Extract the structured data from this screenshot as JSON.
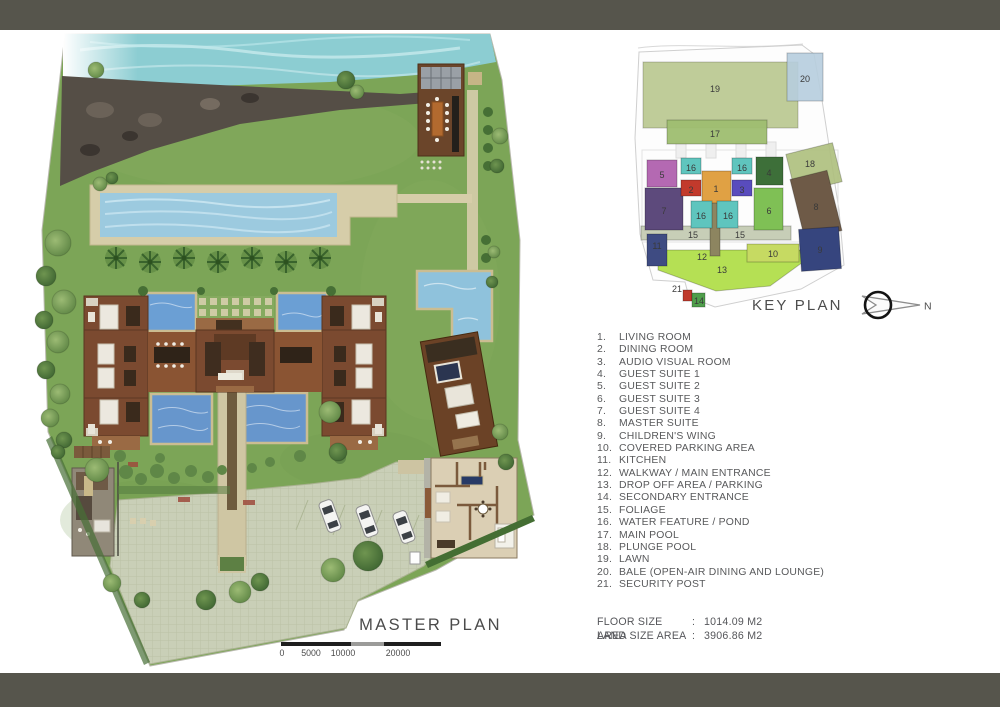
{
  "window": {
    "top_bar_color": "#56554c"
  },
  "master_plan": {
    "title": "MASTER PLAN",
    "scale_bar": {
      "labels": [
        "0",
        "5000",
        "10000",
        "20000"
      ],
      "positions": [
        1,
        30,
        62,
        117
      ],
      "segments": [
        {
          "w": 70,
          "c": "#1f1f1f"
        },
        {
          "w": 33,
          "c": "#9b9b99"
        },
        {
          "w": 57,
          "c": "#1f1f1f"
        }
      ]
    }
  },
  "key_plan": {
    "title": "KEY PLAN",
    "compass_label": "N",
    "blocks": [
      {
        "label": "19",
        "rect": [
          25,
          24,
          155,
          66
        ],
        "color": "#b5c488",
        "op": 0.85,
        "lx": 97,
        "ly": 51
      },
      {
        "label": "20",
        "rect": [
          169,
          15,
          36,
          48
        ],
        "color": "#b7cede",
        "op": 0.9,
        "lx": 187,
        "ly": 41
      },
      {
        "label": "17",
        "rect": [
          49,
          82,
          100,
          24
        ],
        "color": "#9fbe70",
        "op": 0.95,
        "lx": 97,
        "ly": 96
      },
      {
        "label": "18",
        "rect": [
          172,
          110,
          48,
          40
        ],
        "color": "#aebf7d",
        "op": 0.9,
        "rot": -14,
        "lx": 192,
        "ly": 126
      },
      {
        "label": "15",
        "rect": [
          23,
          188,
          150,
          14
        ],
        "color": "#c5ccb4",
        "op": 0.95,
        "lx": 75,
        "ly": 197
      },
      {
        "label": "15",
        "lx": 122,
        "ly": 197
      },
      {
        "label": "13",
        "poly": "40,212 182,212 185,224 152,248 98,253 40,232",
        "color": "#b2df4b",
        "op": 0.95,
        "lx": 104,
        "ly": 232
      },
      {
        "label": "10",
        "rect": [
          129,
          206,
          52,
          18
        ],
        "color": "#c6da62",
        "lx": 155,
        "ly": 216
      },
      {
        "label": "11",
        "rect": [
          29,
          196,
          20,
          32
        ],
        "color": "#3e4b82",
        "lx": 39,
        "ly": 208
      },
      {
        "label": "12",
        "rect": [
          92,
          160,
          10,
          58
        ],
        "color": "#8d8560",
        "lx": 84,
        "ly": 219
      },
      {
        "label": "21",
        "rect": [
          65,
          252,
          9,
          11
        ],
        "color": "#bf3a2c",
        "lx": 59,
        "ly": 251
      },
      {
        "label": "14",
        "rect": [
          74,
          255,
          13,
          14
        ],
        "color": "#4f9e4b",
        "lx": 81,
        "ly": 263
      },
      {
        "label": "5",
        "rect": [
          29,
          122,
          30,
          27
        ],
        "color": "#b469b2",
        "lx": 44,
        "ly": 137
      },
      {
        "label": "7",
        "rect": [
          27,
          150,
          38,
          42
        ],
        "color": "#5d4a7c",
        "lx": 46,
        "ly": 173
      },
      {
        "label": "2",
        "rect": [
          63,
          142,
          20,
          16
        ],
        "color": "#c23a2c",
        "lx": 73,
        "ly": 152
      },
      {
        "label": "1",
        "rect": [
          84,
          133,
          29,
          32
        ],
        "color": "#e0a144",
        "lx": 98,
        "ly": 151
      },
      {
        "label": "3",
        "rect": [
          114,
          142,
          20,
          16
        ],
        "color": "#594cbd",
        "lx": 124,
        "ly": 152
      },
      {
        "label": "16",
        "rect": [
          63,
          120,
          20,
          16
        ],
        "color": "#5fc5be",
        "lx": 73,
        "ly": 130
      },
      {
        "label": "16",
        "rect": [
          114,
          120,
          20,
          16
        ],
        "color": "#5fc5be",
        "lx": 124,
        "ly": 130
      },
      {
        "label": "16",
        "rect": [
          73,
          163,
          21,
          27
        ],
        "color": "#5fc5be",
        "lx": 83,
        "ly": 178
      },
      {
        "label": "16",
        "rect": [
          99,
          163,
          21,
          27
        ],
        "color": "#5fc5be",
        "lx": 110,
        "ly": 178
      },
      {
        "label": "4",
        "rect": [
          138,
          119,
          27,
          28
        ],
        "color": "#3d6f39",
        "lx": 151,
        "ly": 135
      },
      {
        "label": "6",
        "rect": [
          136,
          150,
          29,
          42
        ],
        "color": "#7fc055",
        "lx": 151,
        "ly": 173
      },
      {
        "label": "8",
        "rect": [
          179,
          136,
          38,
          62
        ],
        "color": "#6e5a47",
        "rot": -14,
        "lx": 198,
        "ly": 169
      },
      {
        "label": "9",
        "rect": [
          182,
          190,
          40,
          42
        ],
        "color": "#36457e",
        "rot": -4,
        "lx": 202,
        "ly": 212
      }
    ]
  },
  "legend": {
    "items": [
      {
        "num": "1.",
        "label": "LIVING ROOM"
      },
      {
        "num": "2.",
        "label": "DINING ROOM"
      },
      {
        "num": "3.",
        "label": "AUDIO VISUAL ROOM"
      },
      {
        "num": "4.",
        "label": "GUEST SUITE 1"
      },
      {
        "num": "5.",
        "label": "GUEST SUITE 2"
      },
      {
        "num": "6.",
        "label": "GUEST SUITE 3"
      },
      {
        "num": "7.",
        "label": "GUEST SUITE 4"
      },
      {
        "num": "8.",
        "label": "MASTER SUITE"
      },
      {
        "num": "9.",
        "label": "CHILDREN'S WING"
      },
      {
        "num": "10.",
        "label": "COVERED PARKING AREA"
      },
      {
        "num": "11.",
        "label": "KITCHEN"
      },
      {
        "num": "12.",
        "label": "WALKWAY / MAIN ENTRANCE"
      },
      {
        "num": "13.",
        "label": "DROP OFF AREA / PARKING"
      },
      {
        "num": "14.",
        "label": "SECONDARY ENTRANCE"
      },
      {
        "num": "15.",
        "label": "FOLIAGE"
      },
      {
        "num": "16.",
        "label": "WATER FEATURE / POND"
      },
      {
        "num": "17.",
        "label": "MAIN POOL"
      },
      {
        "num": "18.",
        "label": "PLUNGE POOL"
      },
      {
        "num": "19.",
        "label": "LAWN"
      },
      {
        "num": "20.",
        "label": "BALE (OPEN-AIR DINING AND LOUNGE)"
      },
      {
        "num": "21.",
        "label": "SECURITY POST"
      }
    ]
  },
  "areas": {
    "rows": [
      {
        "label": "FLOOR SIZE AREA",
        "colon": ":",
        "value": "1014.09 M2"
      },
      {
        "label": "LAND SIZE AREA",
        "colon": ":",
        "value": "3906.86 M2"
      }
    ]
  }
}
